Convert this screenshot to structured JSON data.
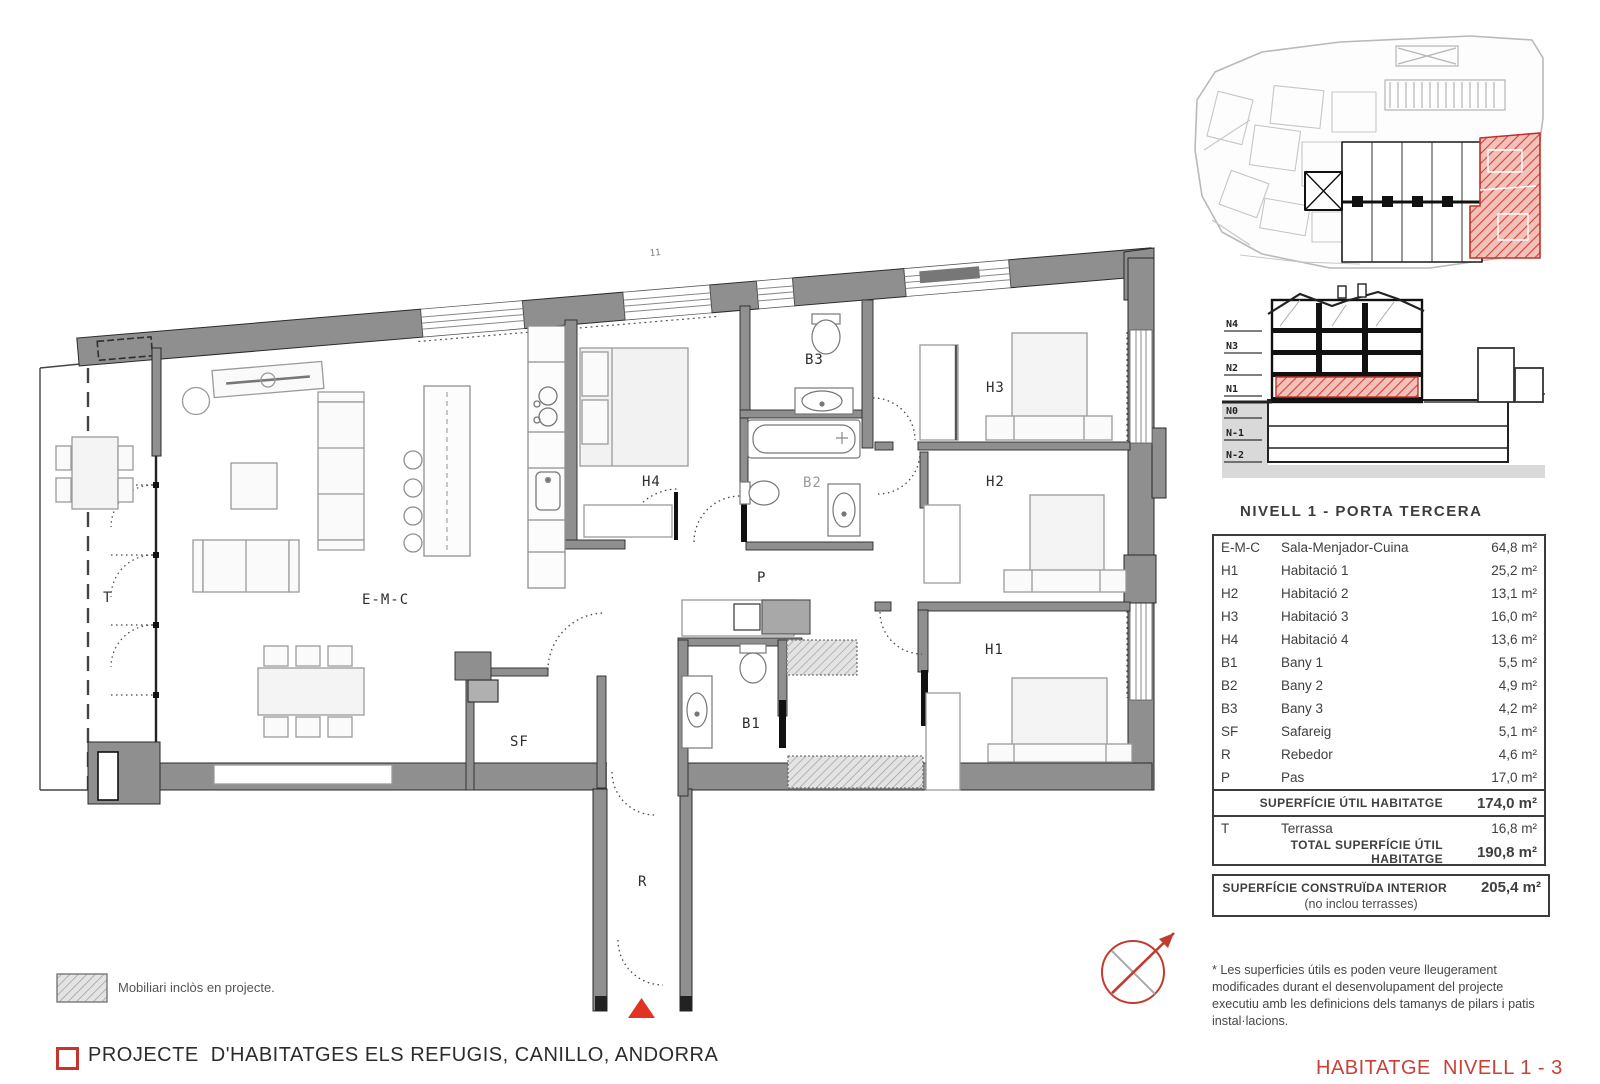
{
  "sheet": {
    "plan_title": "NIVELL 1 - PORTA TERCERA",
    "project_title": "PROJECTE  D'HABITATGES ELS REFUGIS, CANILLO, ANDORRA",
    "sheet_label": "HABITATGE  NIVELL 1 - 3"
  },
  "area_table": {
    "rows": [
      {
        "code": "E-M-C",
        "name": "Sala-Menjador-Cuina",
        "area": "64,8 m²"
      },
      {
        "code": "H1",
        "name": "Habitació 1",
        "area": "25,2 m²"
      },
      {
        "code": "H2",
        "name": "Habitació 2",
        "area": "13,1 m²"
      },
      {
        "code": "H3",
        "name": "Habitació 3",
        "area": "16,0 m²"
      },
      {
        "code": "H4",
        "name": "Habitació 4",
        "area": "13,6 m²"
      },
      {
        "code": "B1",
        "name": "Bany 1",
        "area": "5,5 m²"
      },
      {
        "code": "B2",
        "name": "Bany 2",
        "area": "4,9 m²"
      },
      {
        "code": "B3",
        "name": "Bany 3",
        "area": "4,2 m²"
      },
      {
        "code": "SF",
        "name": "Safareig",
        "area": "5,1 m²"
      },
      {
        "code": "R",
        "name": "Rebedor",
        "area": "4,6 m²"
      },
      {
        "code": "P",
        "name": "Pas",
        "area": "17,0 m²"
      }
    ],
    "subtotal": {
      "label": "SUPERFÍCIE ÚTIL HABITATGE",
      "value": "174,0 m²"
    },
    "terrace_row": {
      "code": "T",
      "name": "Terrassa",
      "area": "16,8 m²"
    },
    "total": {
      "label": "TOTAL SUPERFÍCIE ÚTIL HABITATGE",
      "value": "190,8 m²"
    },
    "built": {
      "label": "SUPERFÍCIE CONSTRUÏDA INTERIOR",
      "value": "205,4 m²",
      "note": "(no inclou terrasses)"
    }
  },
  "plan": {
    "room_labels": [
      "T",
      "E-M-C",
      "SF",
      "B1",
      "P",
      "R",
      "H4",
      "B3",
      "B2",
      "H3",
      "H2",
      "H1"
    ],
    "annotations": [
      {
        "text": "11"
      }
    ]
  },
  "section": {
    "levels": [
      "N4",
      "N3",
      "N2",
      "N1",
      "N0",
      "N-1",
      "N-2"
    ],
    "highlighted_level": "N1"
  },
  "legend": {
    "furniture_label": "Mobiliari inclòs en projecte."
  },
  "footnote": "* Les superficies útils es poden veure lleugerament modificades durant el desenvolupament del projecte executiu amb les definicions dels tamanys de pilars i patis instal·lacions.",
  "colors": {
    "accent_red": "#c7342c",
    "wall_gray": "#8f8f8f",
    "highlight_red": "#d63a2f"
  }
}
